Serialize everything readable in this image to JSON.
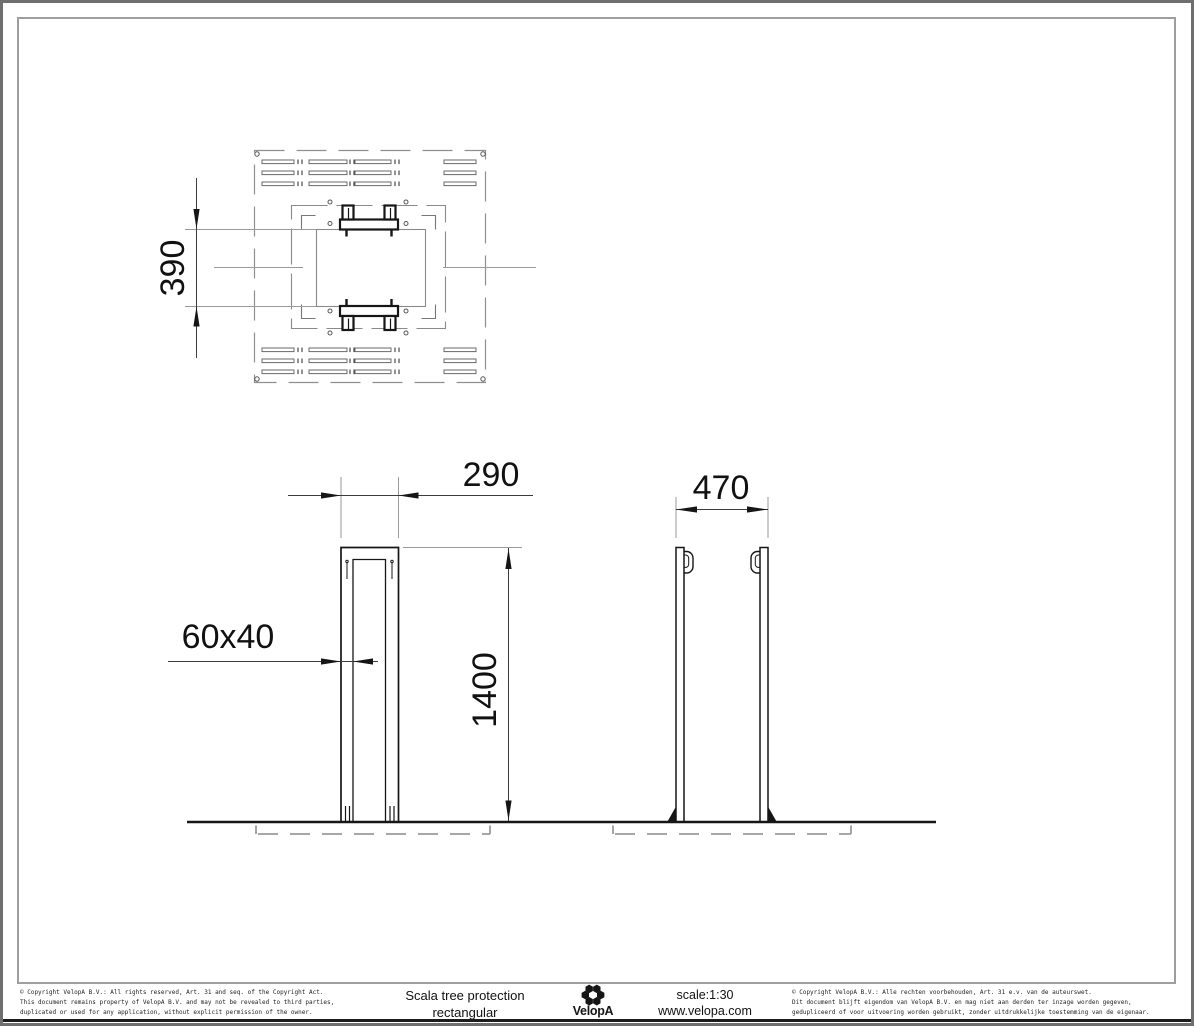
{
  "drawing": {
    "dimensions": {
      "plan_opening_height": "390",
      "front_width": "290",
      "post_profile": "60x40",
      "height": "1400",
      "side_width": "470"
    }
  },
  "title_block": {
    "copyright_left": {
      "line1": "© Copyright VelopA B.V.: All rights reserved, Art. 31 and seq. of the Copyright Act.",
      "line2": "This document remains property of VelopA B.V. and may not be revealed to third parties,",
      "line3": "duplicated or used for any application, without explicit permission of the owner."
    },
    "product": {
      "line1": "Scala tree protection",
      "line2": "rectangular"
    },
    "logo_text": "VelopA",
    "scale_label": "scale:1:30",
    "website": "www.velopa.com",
    "copyright_right": {
      "line1": "© Copyright VelopA B.V.: Alle rechten voorbehouden, Art. 31 e.v. van de auteurswet.",
      "line2": "Dit document blijft eigendom van VelopA B.V. en mag niet aan derden ter inzage worden gegeven,",
      "line3": "gedupliceerd of voor uitvoering worden gebruikt, zonder uitdrukkelijke toestemming van de eigenaar."
    }
  },
  "colors": {
    "line": "#161616",
    "thin_line": "#8a8a8a",
    "dash": "#999999",
    "dim_line": "#3c3c3c",
    "border_outer": "#6f6f6f",
    "border_inner": "#9e9e9e"
  }
}
